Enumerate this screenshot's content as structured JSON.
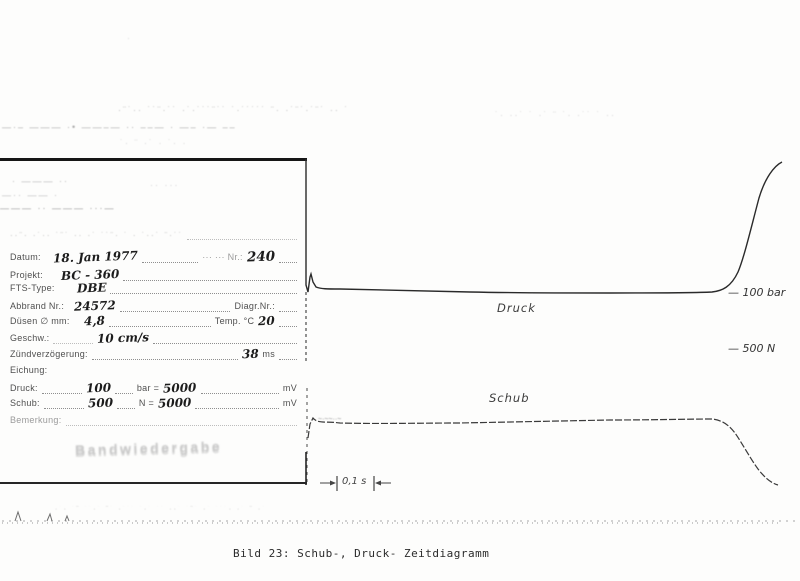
{
  "meta": {
    "caption": "Bild 23: Schub-, Druck- Zeitdiagramm"
  },
  "form": {
    "header_noise": "··¨· ·˙·· ˙¨˙ ·· ·˙ ˙˙¨· ˙ · ˙··˙ ¨·˙˙",
    "fields": {
      "datum_label": "Datum:",
      "datum_value": "18. Jan 1977",
      "datum_right_label": "··· ··· Nr.:",
      "datum_right_value": "240",
      "projekt_label": "Projekt:",
      "projekt_value": "BC - 360",
      "fts_label": "FTS-Type:",
      "fts_value": "DBE",
      "abbrand_label": "Abbrand Nr.:",
      "abbrand_value": "24572",
      "diagr_label": "Diagr.Nr.:",
      "duesen_label": "Düsen ∅ mm:",
      "duesen_value": "4,8",
      "temp_label": "Temp. °C",
      "temp_value": "20",
      "geschw_label": "Geschw.:",
      "geschw_value": "10 cm/s",
      "zuend_label": "Zündverzögerung:",
      "zuend_value": "38",
      "zuend_unit": "ms",
      "eichung_label": "Eichung:",
      "druck_label": "Druck:",
      "druck_v1": "100",
      "druck_u1": "bar =",
      "druck_v2": "5000",
      "druck_u2": "mV",
      "schub_label": "Schub:",
      "schub_v1": "500",
      "schub_u1": "N =",
      "schub_v2": "5000",
      "schub_u2": "mV",
      "bemerkung_label": "Bemerkung:"
    },
    "stamp": "Bandwiedergabe"
  },
  "traces": {
    "druck_label": "Druck",
    "schub_label": "Schub",
    "bar_marker": "— 100 bar",
    "n_marker": "— 500 N",
    "time_scale": "0,1 s"
  },
  "chart_data": {
    "type": "line",
    "title": "Bild 23: Schub-, Druck- Zeitdiagramm",
    "x_axis": "Zeit, s (keine Achse gezeichnet; Skalenbalken 0,1 s, Schreibgeschw. 10 cm/s)",
    "grid": false,
    "axes_visible": false,
    "calibration": {
      "druck": "100 bar = 5000 mV",
      "schub": "500 N = 5000 mV"
    },
    "scale_markers": [
      {
        "series": "Druck",
        "label": "100 bar",
        "position": "at plateau level, right end"
      },
      {
        "series": "Schub",
        "label": "500 N",
        "position": "above plateau level, right end"
      }
    ],
    "series": [
      {
        "name": "Druck",
        "x_s": [
          0,
          0.01,
          0.03,
          0.06,
          0.15,
          0.3,
          0.45,
          0.6,
          0.75,
          0.9,
          1.0,
          1.05,
          1.1,
          1.15,
          1.2,
          1.25
        ],
        "level": [
          0,
          1.15,
          0.96,
          1.0,
          1.0,
          0.99,
          0.98,
          0.98,
          0.98,
          0.99,
          1.02,
          1.1,
          1.55,
          2.3,
          2.95,
          3.2
        ],
        "note": "digitized estimate, level 1.0 = 100 bar mark; ignition spike at start, steep calibration-like rise at end"
      },
      {
        "name": "Schub",
        "x_s": [
          0,
          0.01,
          0.03,
          0.1,
          0.3,
          0.5,
          0.7,
          0.9,
          1.0,
          1.06,
          1.12,
          1.18,
          1.25
        ],
        "level": [
          0,
          0.9,
          1.0,
          0.99,
          0.99,
          1.0,
          1.01,
          1.02,
          1.02,
          0.97,
          0.75,
          0.4,
          0.1
        ],
        "note": "digitized estimate, level 1.0 = plateau (below the 500 N mark); tail-off at burnout"
      }
    ]
  },
  "paths": {
    "druck": "M306,159 V285 L308,292 L310,277 L311,274 L313,282 L316,287 C321,289 327,289 340,289 C380,290 420,291 470,292 C520,293 560,293 610,293 C650,293 690,293 712,292 C722,291 731,287 738,272 C744,258 751,228 759,198 C765,178 774,166 782,162",
    "druck_overshoot": "M306,292 L306,362",
    "schub_overshoot": "M307,388 L307,484",
    "schub": "M308,438 L310,424 L313,418 C318,424 325,421 340,423 C380,424 420,423 460,423 C510,422 560,421 610,420 C650,420 690,419 712,419 C722,420 729,425 735,433 C742,443 750,458 758,469 C765,478 771,483 778,485",
    "box_right_seg": "M306,452 V485",
    "tscale_bars": "M337,476 V491 M374,476 V491",
    "tscale_arrows": "M320,483 H333 M391,483 H378",
    "base_line1": "M2,521 H798",
    "base_line2": "M2,523 H778",
    "base_spikes": "M15,521 L18,512 L21,521 M47,521 L50,514 L52,521 M65,521 L67,516 L69,521"
  },
  "noise": {
    "top_dot": "·",
    "band1a": "·¨˙·· ˙˙¨·˙˙  ·˙·˙˙˙¨˙˙ ˙·˙˙˙˙˙  ¨· ·˙¨˙·˙¨˙ ·· ˙",
    "band1b": "˙· ··˙ ˙ ·˙ ¨ ˙· ·˙˙ ˙ ··",
    "band2": "—·– ——— ·• ——–— ·· ––— · —– ·— ––",
    "band3": "˙·   ¨     ·˙      ·     ˙·      ·",
    "inbox1": "· ——— ··",
    "inbox2": "—·· —— ·",
    "inbox3": "——— ·· ——— ···—",
    "inbox4": "·· ···",
    "schub_scribble": "~·~~··~",
    "bottom_text": "·˙· ˙¨ ˙˙·˙ ¨˙ ·˙˙˙ ˙·˙ ˙˙ ··˙ ˙¨˙ ·˙ ˙˙˙· ·˙ ¨ ·˙"
  }
}
